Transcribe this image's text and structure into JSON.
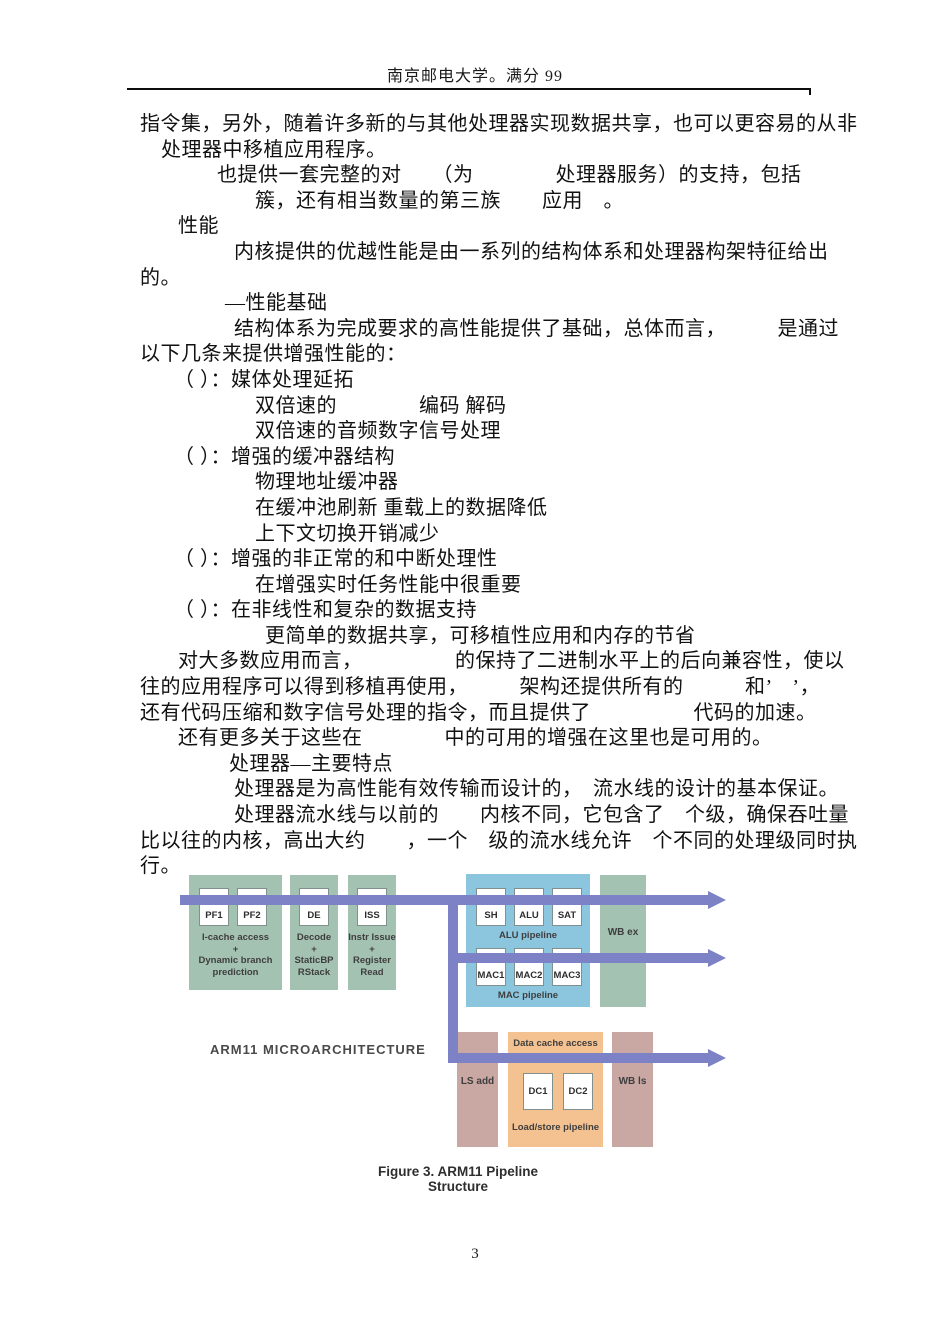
{
  "header": {
    "title": "南京邮电大学。满分 99"
  },
  "body": {
    "lines": [
      "指令集，另外，随着许多新的与其他处理器实现数据共享，也可以更容易的从非",
      "处理器中移植应用程序。",
      "也提供一套完整的对　　（为　　　　处理器服务）的支持，包括",
      "簇，还有相当数量的第三族　　应用　。",
      "性能",
      "内核提供的优越性能是由一系列的结构体系和处理器构架特征给出",
      "的。",
      "—性能基础",
      "结构体系为完成要求的高性能提供了基础，总体而言，　　　是通过",
      "以下几条来提供增强性能的：",
      "（ ）：媒体处理延拓",
      "双倍速的　　　　编码 解码",
      "双倍速的音频数字信号处理",
      "（ ）：增强的缓冲器结构",
      "物理地址缓冲器",
      "在缓冲池刷新 重载上的数据降低",
      "上下文切换开销减少",
      "（ ）：增强的非正常的和中断处理性",
      "在增强实时任务性能中很重要",
      "（ ）：在非线性和复杂的数据支持",
      "更简单的数据共享，可移植性应用和内存的节省",
      "对大多数应用而言，　　　　　的保持了二进制水平上的后向兼容性，使以",
      "往的应用程序可以得到移植再使用，　　　架构还提供所有的　　　和’　’，",
      "还有代码压缩和数字信号处理的指令，而且提供了　　　　　代码的加速。",
      "还有更多关于这些在　　　　中的可用的增强在这里也是可用的。",
      "处理器—主要特点",
      "处理器是为高性能有效传输而设计的，　流水线的设计的基本保证。",
      "处理器流水线与以前的　　内核不同，它包含了　个级，确保吞吐量",
      "比以往的内核，高出大约　　，一个　级的流水线允许　个不同的处理级同时执",
      "行。"
    ]
  },
  "figure": {
    "title": "ARM11 MICROARCHITECTURE",
    "caption": "Figure 3. ARM11 Pipeline Structure",
    "colors": {
      "stage_green": "#a4c2b2",
      "pipeline_blue": "#8cc5de",
      "loadstore_orange": "#f4c291",
      "writeback_mauve": "#c9a7a3",
      "arrow_purple": "#7d81c5"
    },
    "fetch": {
      "box1": "PF1",
      "box2": "PF2",
      "label": [
        "I-cache access",
        "+",
        "Dynamic branch",
        "prediction"
      ]
    },
    "decode": {
      "box1": "DE",
      "label": [
        "Decode",
        "+",
        "StaticBP",
        "RStack"
      ]
    },
    "issue": {
      "box1": "ISS",
      "label": [
        "Instr Issue",
        "+",
        "Register",
        "Read"
      ]
    },
    "alu_pipeline": {
      "boxes": [
        "SH",
        "ALU",
        "SAT"
      ],
      "label": "ALU pipeline"
    },
    "mac_pipeline": {
      "boxes": [
        "MAC1",
        "MAC2",
        "MAC3"
      ],
      "label": "MAC pipeline"
    },
    "wb_ex": "WB ex",
    "ls_add": "LS add",
    "data_cache": {
      "label": "Data cache access",
      "boxes": [
        "DC1",
        "DC2"
      ],
      "footer": "Load/store pipeline"
    },
    "wb_ls": "WB ls"
  },
  "footer": {
    "page_number": "3"
  }
}
